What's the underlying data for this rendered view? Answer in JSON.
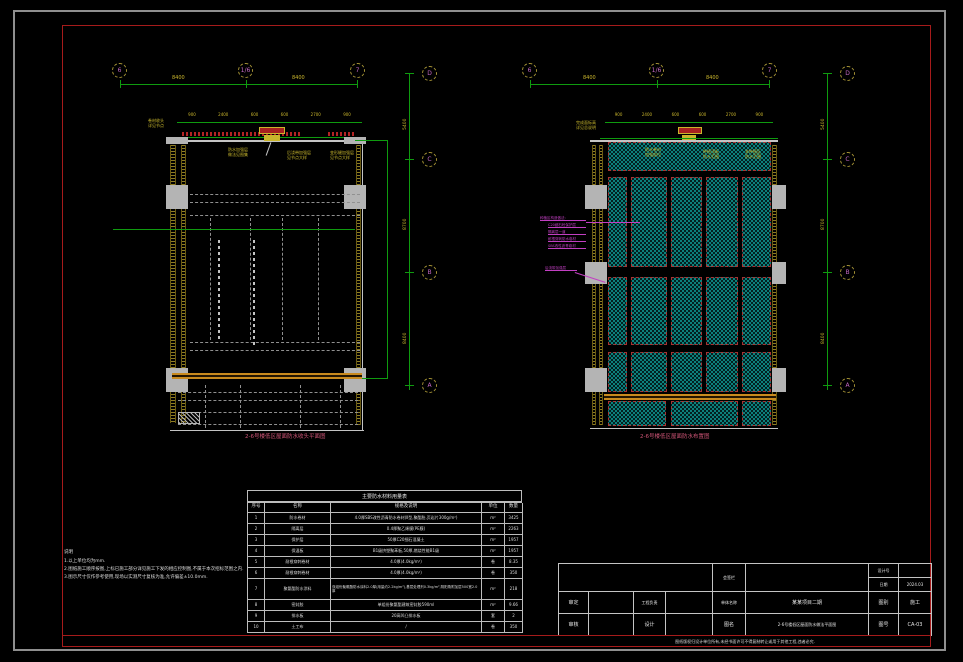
{
  "colors": {
    "background": "#000000",
    "frame_outer": "#8f8f8f",
    "frame_inner": "#a61b1b",
    "dim_green": "#0f9b0f",
    "dim_yellow": "#c9b52c",
    "axis_magenta": "#c468c4",
    "hatch_teal": "#0c807c",
    "panel_red": "#b32424",
    "callout_magenta": "#c23fc2",
    "caption_pink": "#d05577"
  },
  "drawing": {
    "axes": {
      "left_top_labels": [
        "6",
        "1/6",
        "7"
      ],
      "right_top_labels": [
        "6",
        "1/6",
        "7"
      ],
      "left_side_labels": [
        "D",
        "C",
        "B",
        "A"
      ],
      "right_side_labels": [
        "D",
        "C",
        "B",
        "A"
      ],
      "left_top_dims": [
        "8400",
        "8400"
      ],
      "right_top_dims": [
        "8400",
        "8400"
      ],
      "left_side_dims": [
        "5400",
        "8700",
        "8400"
      ],
      "right_side_dims": [
        "5400",
        "8700",
        "8400"
      ],
      "left_inner_dims": [
        "900",
        "2400",
        "600",
        "600",
        "2700",
        "900"
      ],
      "right_inner_dims": [
        "900",
        "2400",
        "600",
        "600",
        "2700",
        "900"
      ]
    },
    "left_plan": {
      "caption": "2-6号楼低区屋面防水收头平面图",
      "outside_label": "卷材收头\n详见节点",
      "ann1": "防水加强层\n做法见图集",
      "ann2": "后浇带加强层\n见节点大样",
      "ann3": "变形缝加强层\n见节点大样"
    },
    "right_plan": {
      "caption": "2-6号楼低区屋面防水布置图",
      "outside_label": "完成面标高\n详见总说明",
      "ann1": "防水卷材\n加强部位",
      "ann2": "种植顶板\n防水范围",
      "ann3": "非种植区\n防水范围",
      "callout_lines": [
        "种植区构造做法:",
        "C20细石砼保护层",
        "隔离层一道",
        "耐根穿刺防水卷材",
        "SBS改性沥青卷材"
      ],
      "callout_single": "后浇带加强层"
    }
  },
  "table": {
    "title": "主要防水材料用量表",
    "headers": [
      "序号",
      "名称",
      "规格及说明",
      "单位",
      "数量"
    ],
    "rows": [
      [
        "1",
        "防水卷材",
        "4.0厚SBS改性沥青防水卷材(Ⅱ型,聚酯胎,页岩片300g/m²)",
        "m²",
        "3425"
      ],
      [
        "2",
        "隔离层",
        "0.4厚聚乙烯膜(PE膜)",
        "m²",
        "2263"
      ],
      [
        "3",
        "保护层",
        "50厚C20细石混凝土",
        "m²",
        "1957"
      ],
      [
        "4",
        "保温板",
        "B1级挤塑聚苯板,50厚,燃烧性能B1级",
        "m²",
        "1957"
      ],
      [
        "5",
        "耐根穿刺卷材",
        "4.0厚(4.0kg/m²)",
        "卷",
        "8.35"
      ],
      [
        "6",
        "耐根穿刺卷材",
        "4.0厚(4.0kg/m²)",
        "卷",
        "350"
      ],
      [
        "7",
        "聚氨酯防水涂料",
        "双组份聚氨酯防水涂料2.0厚(用量约2.2kg/m²),基层处理剂0.3kg/m²,阴阳角附加层500宽2.0厚",
        "m²",
        "218"
      ],
      [
        "8",
        "密封胶",
        "单组份聚氨酯建筑密封胶590ml",
        "m²",
        "9.66"
      ],
      [
        "9",
        "排水板",
        "20高凹凸排水板",
        "套",
        "2"
      ],
      [
        "10",
        "土工布",
        "/",
        "卷",
        "350"
      ]
    ]
  },
  "notes": {
    "title": "说明",
    "lines": [
      "1.以上单位均为mm.",
      "2.图纸施工顺序按图,上标已施工部分详见施工下发的相应控制图,不属于本次招标范围之内.",
      "3.图示尺寸仅作参考使用,现场以实测尺寸复核为准,允许偏差±10.0mm."
    ]
  },
  "titleblock": {
    "stamp_label": "会签栏",
    "design_no_label": "设计号",
    "design_no_value": "",
    "date_label": "日期",
    "date_value": "2024.03",
    "approve_label": "审定",
    "lead_label": "工程负责",
    "unit_label": "单体名称",
    "unit_value": "某某项目二期",
    "type_label": "图别",
    "type_value": "施工",
    "check_label": "审核",
    "design_label": "设计",
    "name_label": "图名",
    "name_value": "2-6号楼低区屋面防水做法平面图",
    "no_label": "图号",
    "no_value": "CA-03",
    "disclaimer": "图纸版权归设计单位所有,未经书面许可不得复制转让或用于其他工程,违者必究."
  }
}
